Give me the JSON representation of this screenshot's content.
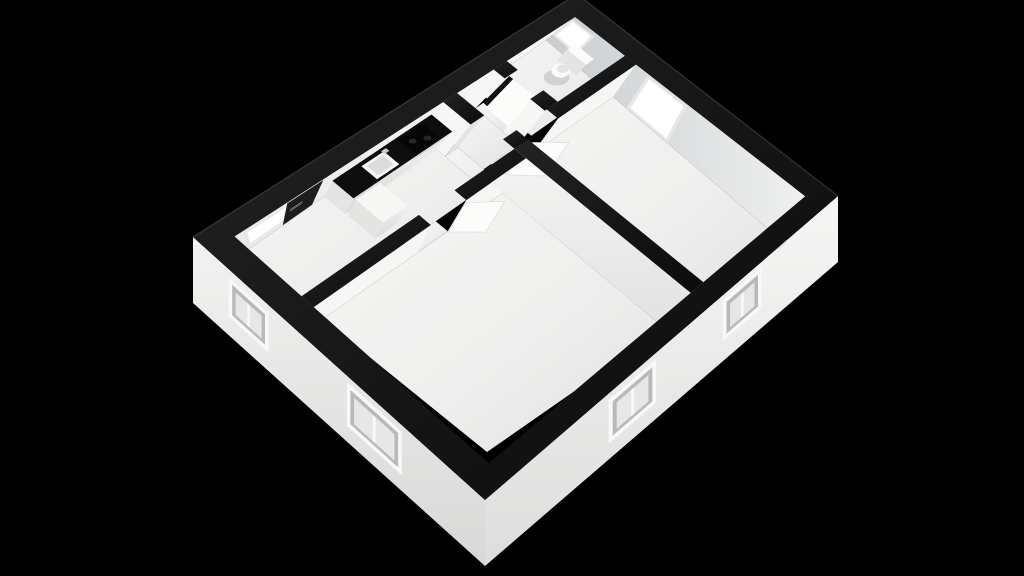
{
  "scene": {
    "type": "3d-floor-plan-dollhouse-render",
    "description": "Isometric cutaway 3D floor plan of a small apartment on a black background, white walls with black wall caps",
    "rooms": [
      {
        "id": "entrance-hall",
        "fixtures": [
          "front-door",
          "entrance-window"
        ]
      },
      {
        "id": "kitchen",
        "fixtures": [
          "counter",
          "sink",
          "cooktop",
          "oven-handle",
          "refrigerator"
        ]
      },
      {
        "id": "hallway",
        "fixtures": []
      },
      {
        "id": "bathroom",
        "fixtures": [
          "toilet",
          "bathroom-door",
          "bathroom-window"
        ]
      },
      {
        "id": "living-room",
        "fixtures": [
          "living-room-door",
          "living-room-window"
        ]
      },
      {
        "id": "bedroom",
        "fixtures": [
          "bedroom-door"
        ]
      }
    ],
    "window_count": 7,
    "door_count": 4
  },
  "colors": {
    "background": "#000000",
    "cap_top": "#161616",
    "face_light": "#f6f6f5",
    "face_mid": "#e4e4e3",
    "window_frame": "#f8f8f7",
    "window_reveal": "#b9b9b9",
    "window_glass": "#e7e7e6",
    "window_bright": "#ffffff",
    "door_dark": "#1d1d1f",
    "handle": "#b4b4b4",
    "leaf": "#fcfcfb",
    "counter_top": "#0d0d0d",
    "cooktop": "#060606",
    "burner": "#262626",
    "steel": "#c9cdcf",
    "sink": "#f7f7f6",
    "sink_inner": "#dcdcdb",
    "toilet": "#fbfbfa",
    "gap": "#0f0f0f",
    "shadow": "rgba(0,0,0,0.12)"
  },
  "projection": {
    "plan_w": 9.3,
    "plan_d": 8.1,
    "cap_quad": [
      [
        193,
        237
      ],
      [
        577,
        -6
      ],
      [
        838,
        196
      ],
      [
        485,
        500
      ]
    ],
    "floor_quad": [
      [
        242,
        254
      ],
      [
        546,
        40
      ],
      [
        786,
        244
      ],
      [
        487,
        452
      ]
    ],
    "floor_rect": [
      0.5,
      0.5,
      8.8,
      7.6
    ],
    "ext_wall_px": 66
  },
  "plan": {
    "floors": [
      {
        "name": "kitchen-entrance-floor",
        "rect": [
          0.5,
          0.5,
          5.25,
          2.45
        ]
      },
      {
        "name": "kitchen-hall-gap-floor",
        "rect": [
          5.25,
          1.35,
          5.6,
          2.45
        ]
      },
      {
        "name": "hallway-floor",
        "rect": [
          5.6,
          0.5,
          6.55,
          2.1
        ]
      },
      {
        "name": "bathroom-floor",
        "rect": [
          6.9,
          0.5,
          8.8,
          2.1
        ]
      },
      {
        "name": "bedroom-floor",
        "rect": [
          0.5,
          2.8,
          5.45,
          7.6
        ]
      },
      {
        "name": "living-room-floor",
        "rect": [
          5.8,
          2.45,
          8.8,
          7.6
        ]
      },
      {
        "name": "bedroom-doorway-floor",
        "rect": [
          3.1,
          2.45,
          3.95,
          2.8
        ]
      },
      {
        "name": "living-doorway-floor",
        "rect": [
          5.8,
          2.1,
          6.6,
          2.45
        ]
      },
      {
        "name": "bathroom-doorway-floor",
        "rect": [
          6.55,
          0.85,
          6.9,
          1.65
        ]
      }
    ],
    "interior_faces": [
      {
        "name": "far-left-wall-inner-face",
        "seg": [
          0.5,
          0.5,
          8.8,
          0.5
        ],
        "fill": "grad:faceLight"
      },
      {
        "name": "far-right-wall-inner-face",
        "seg": [
          8.8,
          0.5,
          8.8,
          7.6
        ],
        "fill": "grad:faceShadow"
      },
      {
        "name": "bedroom-north-wall-face-left",
        "seg": [
          0.5,
          2.8,
          3.1,
          2.8
        ],
        "fill": "face_light"
      },
      {
        "name": "bedroom-north-wall-face-right",
        "seg": [
          3.95,
          2.8,
          5.45,
          2.8
        ],
        "fill": "face_light"
      },
      {
        "name": "bedroom-east-wall-face",
        "seg": [
          5.45,
          2.45,
          5.45,
          7.6
        ],
        "fill": "grad:faceSide"
      },
      {
        "name": "living-north-wall-face",
        "seg": [
          6.6,
          2.45,
          8.8,
          2.45
        ],
        "fill": "face_light"
      },
      {
        "name": "bathroom-wall-face-upper",
        "seg": [
          6.55,
          0.5,
          6.55,
          0.85
        ],
        "fill": "face_light"
      },
      {
        "name": "bathroom-wall-face-lower",
        "seg": [
          6.55,
          1.65,
          6.55,
          2.1
        ],
        "fill": "face_light"
      },
      {
        "name": "kitchen-stub-wall-face",
        "seg": [
          5.25,
          0.5,
          5.25,
          1.35
        ],
        "fill": "face_light"
      },
      {
        "name": "kitchen-stub-wall-end-face",
        "seg": [
          5.25,
          1.35,
          5.6,
          1.35
        ],
        "fill": "face_mid"
      },
      {
        "name": "bathroom-door-leaf",
        "seg": [
          6.72,
          0.87,
          6.72,
          1.63
        ],
        "fill": "leaf",
        "top": 0.93
      }
    ],
    "decals": [
      {
        "name": "entrance-window-frame",
        "seg": [
          0.5,
          0.5,
          8.8,
          0.5
        ],
        "range": [
          0.68,
          1.68
        ],
        "v": [
          0.16,
          0.82
        ],
        "fill": "window_glass"
      },
      {
        "name": "entrance-window-glow",
        "seg": [
          0.5,
          0.5,
          8.8,
          0.5
        ],
        "range": [
          0.75,
          1.6
        ],
        "v": [
          0.21,
          0.77
        ],
        "fill": "window_bright"
      },
      {
        "name": "front-door",
        "seg": [
          0.5,
          0.5,
          8.8,
          0.5
        ],
        "range": [
          1.62,
          2.42
        ],
        "v": [
          0.05,
          1.0
        ],
        "fill": "door_dark"
      },
      {
        "name": "front-door-handle-upper",
        "seg": [
          0.5,
          0.5,
          8.8,
          0.5
        ],
        "range": [
          1.74,
          2.04
        ],
        "v": [
          0.45,
          0.48
        ],
        "fill": "handle"
      },
      {
        "name": "front-door-handle-lower",
        "seg": [
          0.5,
          0.5,
          8.8,
          0.5
        ],
        "range": [
          1.74,
          2.04
        ],
        "v": [
          0.52,
          0.55
        ],
        "fill": "handle"
      },
      {
        "name": "bathroom-window-frame",
        "seg": [
          8.8,
          0.5,
          8.8,
          7.6
        ],
        "range": [
          0.5,
          1.2
        ],
        "v": [
          0.1,
          0.78
        ],
        "fill": "window_glass"
      },
      {
        "name": "bathroom-window-glow",
        "seg": [
          8.8,
          0.5,
          8.8,
          7.6
        ],
        "range": [
          0.56,
          1.14
        ],
        "v": [
          0.15,
          0.72
        ],
        "fill": "window_bright"
      },
      {
        "name": "living-window-frame",
        "seg": [
          8.8,
          0.5,
          8.8,
          7.6
        ],
        "range": [
          2.84,
          4.06
        ],
        "v": [
          0.04,
          0.99
        ],
        "fill": "window_glass"
      },
      {
        "name": "living-window-glow",
        "seg": [
          8.8,
          0.5,
          8.8,
          7.6
        ],
        "range": [
          2.92,
          3.98
        ],
        "v": [
          0.09,
          0.93
        ],
        "fill": "window_bright"
      },
      {
        "name": "bathroom-door-gap",
        "seg": [
          6.72,
          0.85,
          6.72,
          1.65
        ],
        "range": [
          0.85,
          0.97
        ],
        "v": [
          0.06,
          0.95
        ],
        "fill": "gap"
      }
    ],
    "fixtures": [
      {
        "type": "band",
        "name": "kitchen-cabinet-front",
        "seg": [
          2.75,
          1.12,
          5.25,
          1.12
        ],
        "top": 0.58,
        "bot": 0,
        "fill": "grad:cabinetFront"
      },
      {
        "type": "band",
        "name": "kitchen-cabinet-end",
        "seg": [
          2.75,
          0.5,
          2.75,
          1.12
        ],
        "top": 0.58,
        "bot": 0,
        "fill": "face_mid"
      },
      {
        "type": "slab",
        "name": "kitchen-counter-top",
        "rect": [
          2.75,
          0.5,
          5.25,
          1.12
        ],
        "zf": 0.58,
        "fill": "counter_top"
      },
      {
        "type": "band",
        "name": "oven-handle",
        "seg": [
          4.3,
          1.12,
          5.0,
          1.12
        ],
        "top": 0.53,
        "bot": 0.46,
        "fill": "steel"
      },
      {
        "type": "band",
        "name": "refrigerator-front",
        "seg": [
          2.75,
          1.98,
          3.35,
          1.98
        ],
        "top": 0.6,
        "bot": 0,
        "fill": "grad:cabinetFront"
      },
      {
        "type": "band",
        "name": "refrigerator-side",
        "seg": [
          2.75,
          1.18,
          2.75,
          1.98
        ],
        "top": 0.6,
        "bot": 0,
        "fill": "face_mid"
      },
      {
        "type": "slab",
        "name": "refrigerator-top",
        "rect": [
          2.75,
          1.18,
          3.35,
          1.98
        ],
        "zf": 0.6,
        "fill": "sink"
      },
      {
        "type": "slab",
        "name": "sink-rim",
        "rect": [
          3.38,
          0.6,
          3.94,
          1.06
        ],
        "zf": 0.585,
        "fill": "sink"
      },
      {
        "type": "slab",
        "name": "sink-basin",
        "rect": [
          3.46,
          0.66,
          3.86,
          0.99
        ],
        "zf": 0.585,
        "fill": "sink_inner"
      },
      {
        "type": "slab",
        "name": "faucet",
        "rect": [
          3.86,
          0.58,
          3.98,
          0.68
        ],
        "zf": 0.64,
        "fill": "steel"
      },
      {
        "type": "slab",
        "name": "cooktop",
        "rect": [
          4.32,
          0.56,
          4.96,
          1.08
        ],
        "zf": 0.585,
        "fill": "cooktop"
      },
      {
        "type": "ellipse",
        "name": "burner-front",
        "at": [
          4.52,
          0.78
        ],
        "zf": 0.585,
        "rx": 4,
        "ry": 2.5,
        "fill": "burner"
      },
      {
        "type": "ellipse",
        "name": "burner-rear",
        "at": [
          4.78,
          0.92
        ],
        "zf": 0.585,
        "rx": 4,
        "ry": 2.5,
        "fill": "burner"
      },
      {
        "type": "ellipse",
        "name": "toilet-shadow",
        "at": [
          8.3,
          1.34
        ],
        "zf": 0,
        "rx": 13,
        "ry": 8,
        "fill": "shadow"
      },
      {
        "type": "slab",
        "name": "toilet-tank-top",
        "rect": [
          8.55,
          1.02,
          8.78,
          1.58
        ],
        "zf": 0.45,
        "fill": "toilet"
      },
      {
        "type": "band",
        "name": "toilet-tank-front",
        "seg": [
          8.55,
          1.02,
          8.55,
          1.58
        ],
        "top": 0.45,
        "bot": 0.08,
        "fill": "face_mid"
      },
      {
        "type": "ellipse",
        "name": "toilet-bowl",
        "at": [
          8.28,
          1.3
        ],
        "zf": 0.22,
        "rx": 9,
        "ry": 7,
        "fill": "toilet"
      },
      {
        "type": "ellipse",
        "name": "toilet-seat",
        "at": [
          8.33,
          1.3
        ],
        "zf": 0.24,
        "rx": 6,
        "ry": 4.2,
        "fill": "face_mid"
      },
      {
        "type": "leaf",
        "name": "bedroom-door-leaf",
        "seg": [
          3.95,
          2.82,
          4.5,
          3.32
        ],
        "top": 0.93,
        "fill": "leaf"
      },
      {
        "type": "leaf",
        "name": "living-room-door-leaf",
        "seg": [
          5.82,
          2.5,
          6.4,
          3.06
        ],
        "top": 0.93,
        "fill": "leaf"
      }
    ],
    "wall_caps": [
      {
        "name": "bedroom-north-wall-cap-left",
        "rect": [
          0.5,
          2.45,
          3.1,
          2.8
        ]
      },
      {
        "name": "bedroom-north-wall-cap-right",
        "rect": [
          3.95,
          2.45,
          5.45,
          2.8
        ]
      },
      {
        "name": "bedroom-living-wall-cap",
        "rect": [
          5.45,
          2.45,
          5.8,
          7.6
        ]
      },
      {
        "name": "living-north-wall-cap-stub",
        "rect": [
          5.45,
          2.1,
          5.8,
          2.45
        ]
      },
      {
        "name": "living-north-wall-cap",
        "rect": [
          6.6,
          2.1,
          8.8,
          2.45
        ]
      },
      {
        "name": "bathroom-wall-cap-upper",
        "rect": [
          6.55,
          0.5,
          6.9,
          0.85
        ]
      },
      {
        "name": "bathroom-wall-cap-lower",
        "rect": [
          6.55,
          1.65,
          6.9,
          2.1
        ]
      },
      {
        "name": "kitchen-stub-wall-cap",
        "rect": [
          5.25,
          0.5,
          5.6,
          1.35
        ]
      }
    ],
    "exterior": {
      "faces": [
        {
          "name": "exterior-wall-southwest",
          "seg": [
            0,
            0,
            0,
            8.1
          ],
          "fill": "grad:extLeft"
        },
        {
          "name": "exterior-wall-southeast",
          "seg": [
            0,
            8.1,
            9.3,
            8.1
          ],
          "fill": "grad:extRight"
        }
      ],
      "windows": [
        {
          "name": "entrance-exterior-window",
          "face": 0,
          "range": [
            1.05,
            2.2
          ],
          "v": [
            0.12,
            0.72
          ]
        },
        {
          "name": "bedroom-exterior-window-west",
          "face": 0,
          "range": [
            4.4,
            5.9
          ],
          "v": [
            0.1,
            0.76
          ]
        },
        {
          "name": "bedroom-exterior-window-south",
          "face": 1,
          "range": [
            2.85,
            4.05
          ],
          "v": [
            0.1,
            0.76
          ]
        },
        {
          "name": "living-exterior-window-south",
          "face": 1,
          "range": [
            5.85,
            6.95
          ],
          "v": [
            0.08,
            0.7
          ]
        }
      ]
    }
  }
}
